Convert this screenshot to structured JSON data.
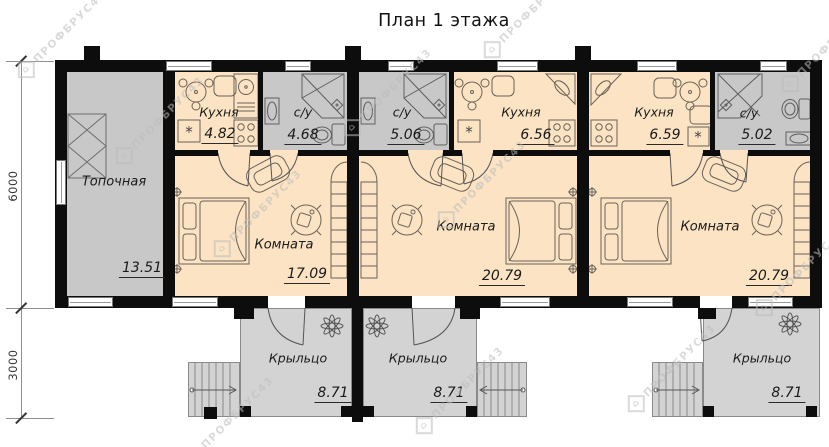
{
  "title": "План 1 этажа",
  "watermark": {
    "text": "ПРОФБРУС43",
    "house_glyph": "⌂"
  },
  "symbols": {
    "vent": "*"
  },
  "dimensions": {
    "main_depth": "6000",
    "porch_depth": "3000"
  },
  "rooms": {
    "boiler": {
      "name": "Топочная",
      "area": "13.51"
    },
    "kitchen1": {
      "name": "Кухня",
      "area": "4.82"
    },
    "bath1": {
      "name": "с/у",
      "area": "4.68"
    },
    "bath2": {
      "name": "с/у",
      "area": "5.06"
    },
    "kitchen2": {
      "name": "Кухня",
      "area": "6.56"
    },
    "kitchen3": {
      "name": "Кухня",
      "area": "6.59"
    },
    "bath3": {
      "name": "с/у",
      "area": "5.02"
    },
    "room1": {
      "name": "Комната",
      "area": "17.09"
    },
    "room2": {
      "name": "Комната",
      "area": "20.79"
    },
    "room3": {
      "name": "Комната",
      "area": "20.79"
    },
    "porch1": {
      "name": "Крыльцо",
      "area": "8.71"
    },
    "porch2": {
      "name": "Крыльцо",
      "area": "8.71"
    },
    "porch3": {
      "name": "Крыльцо",
      "area": "8.71"
    }
  },
  "colors": {
    "wall": "#0d0d0d",
    "floor": "#fbe3c3",
    "wet": "#c8c8c8",
    "porch": "#d3d3d3",
    "line": "#6b6257",
    "outline": "#8a8a8a",
    "dim": "#8f8f8f",
    "text": "#1a1a1a",
    "watermark": "#bdbdbd"
  }
}
